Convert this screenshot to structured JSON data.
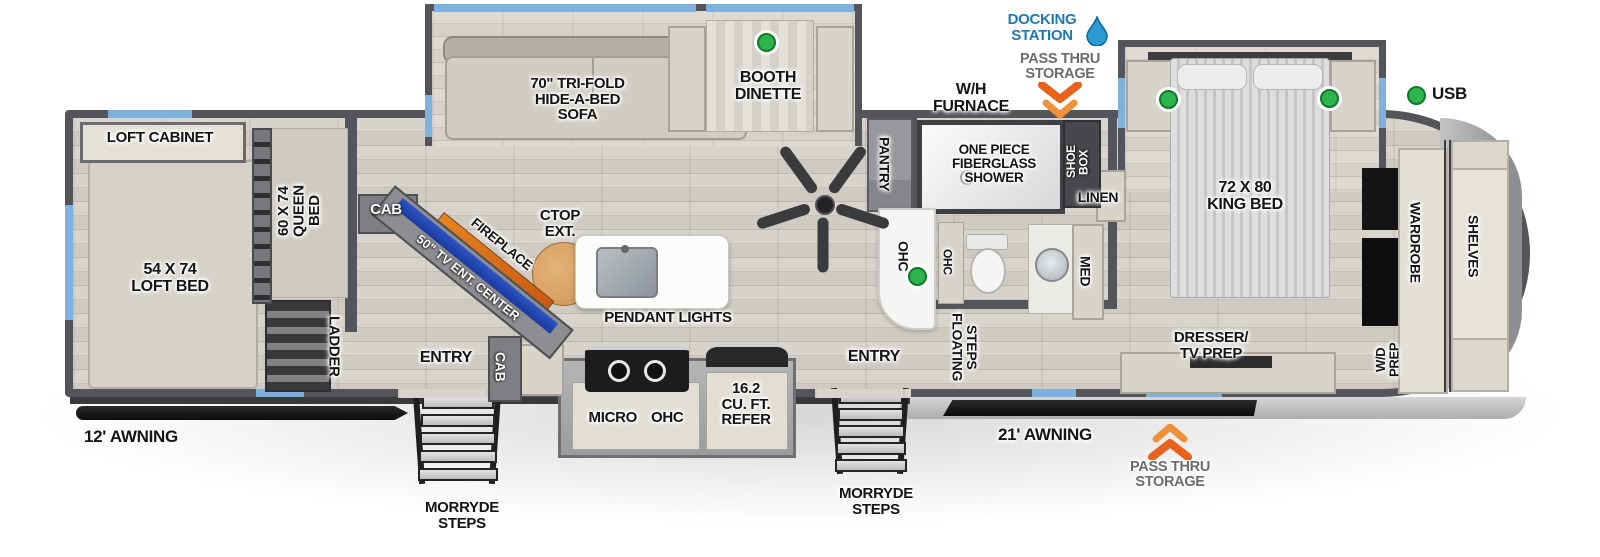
{
  "title": "Fifth wheel RV floorplan",
  "colors": {
    "wall_gray": "#54555a",
    "window_blue": "#7fb1de",
    "usb_green": "#2db44c",
    "arrow_orange": "#e8611d",
    "docking_blue": "#1b7cb5",
    "furniture_beige": "#d8d4c9",
    "tv_blue": "#2b55c4",
    "fireplace_orange": "#e8821f",
    "countertop_wood": "#d8a363"
  },
  "exterior": {
    "docking_station": "DOCKING\nSTATION",
    "pass_thru_storage_top": "PASS THRU\nSTORAGE",
    "wh_furnace": "W/H\nFURNACE",
    "usb": "USB",
    "awning_left": "12' AWNING",
    "awning_right": "21' AWNING",
    "morryde_steps_left": "MORRYDE\nSTEPS",
    "morryde_steps_right": "MORRYDE\nSTEPS",
    "pass_thru_storage_bottom": "PASS THRU\nSTORAGE"
  },
  "garage": {
    "loft_cabinet": "LOFT CABINET",
    "loft_bed": "54 X 74\nLOFT BED",
    "queen_bed": "60 X 74\nQUEEN\nBED",
    "ladder": "LADDER"
  },
  "living": {
    "sofa": "70\" TRI-FOLD\nHIDE-A-BED\nSOFA",
    "dinette": "BOOTH\nDINETTE",
    "cab_upper": "CAB",
    "tv_center": "50\" TV ENT. CENTER",
    "fireplace": "FIREPLACE",
    "ctop_ext": "CTOP\nEXT.",
    "pendant_lights": "PENDANT LIGHTS",
    "entry_left": "ENTRY",
    "cab_lower": "CAB"
  },
  "kitchen": {
    "micro": "MICRO",
    "ohc": "OHC",
    "refer": "16.2\nCU. FT.\nREFER",
    "pantry": "PANTRY",
    "ohc_desk": "OHC",
    "entry_right": "ENTRY"
  },
  "bath": {
    "shower": "ONE PIECE\nFIBERGLASS\nSHOWER",
    "shoe_box": "SHOE\nBOX",
    "linen": "LINEN",
    "med": "MED",
    "ohc": "OHC"
  },
  "bedroom": {
    "king_bed": "72 X 80\nKING BED",
    "floating_steps": "FLOATING\nSTEPS",
    "dresser": "DRESSER/\nTV PREP",
    "wardrobe": "WARDROBE",
    "shelves": "SHELVES",
    "wd_prep": "W/D\nPREP"
  }
}
